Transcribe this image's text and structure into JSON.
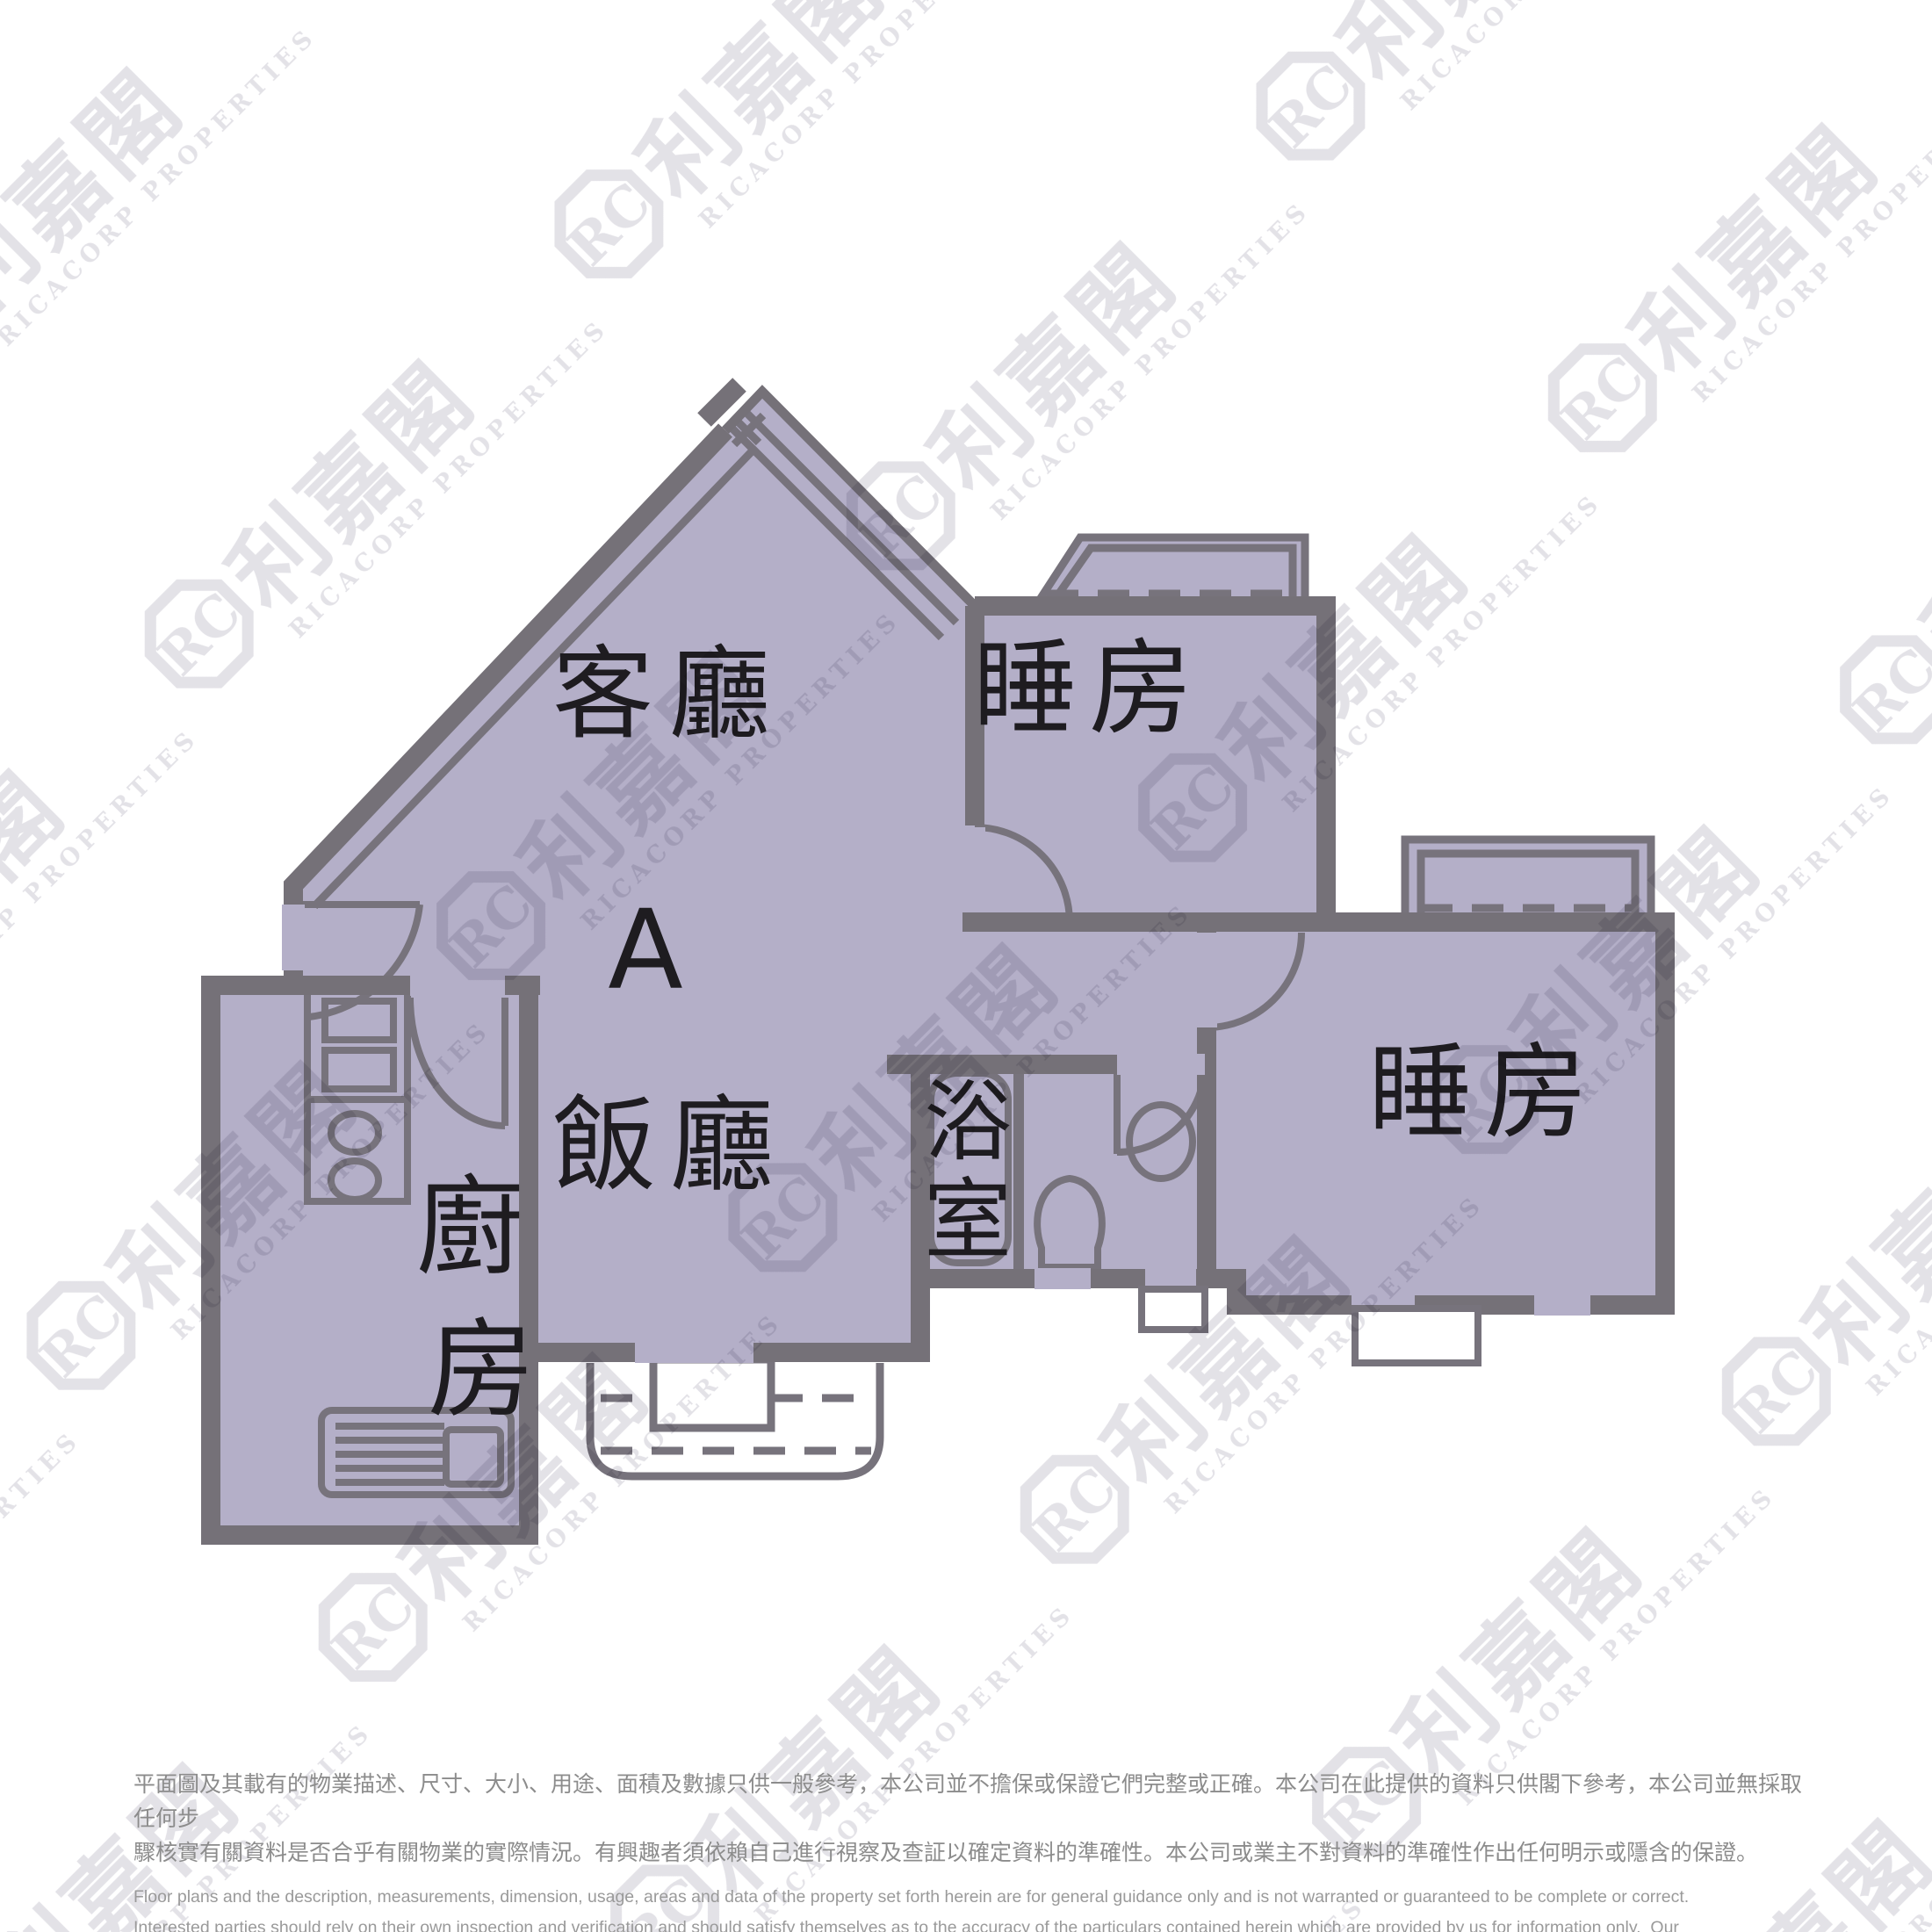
{
  "floor_plan": {
    "unit_label": "A",
    "rooms": {
      "living_room": "客廳",
      "dining_room": "飯廳",
      "bedroom_top": "睡房",
      "bedroom_right": "睡房",
      "kitchen_char_1": "廚",
      "kitchen_char_2": "房",
      "bathroom_char_1": "浴",
      "bathroom_char_2": "室"
    },
    "colors": {
      "floor": "#b4afc8",
      "wall": "#757178",
      "line": "#77737c",
      "label": "#1e1c20",
      "white": "#ffffff"
    }
  },
  "watermark": {
    "cjk": "利嘉閣",
    "latin": "RICACORP PROPERTIES",
    "logo_text": "RC",
    "color": "#e3e2e7"
  },
  "disclaimer": {
    "zh": [
      "平面圖及其載有的物業描述、尺寸、大小、用途、面積及數據只供一般參考，本公司並不擔保或保證它們完整或正確。本公司在此提供的資料只供閣下參考，本公司並無採取任何步",
      "驟核實有關資料是否合乎有關物業的實際情況。有興趣者須依賴自己進行視察及查証以確定資料的準確性。本公司或業主不對資料的準確性作出任何明示或隱含的保證。"
    ],
    "en": [
      "Floor plans and the description, measurements, dimension, usage, areas and data of the property set forth herein are for general guidance only and is not warranted or guaranteed to be complete or correct.",
      "Interested parties should rely on their own inspection and verification and should satisfy themselves as to the accuracy of the particulars contained herein which are provided by us for information only.  Our",
      "Company has not taken any step to verify whether the information reflects the actual status of the property.  No warranty for accuracy is given or implied by the owners or us."
    ]
  }
}
